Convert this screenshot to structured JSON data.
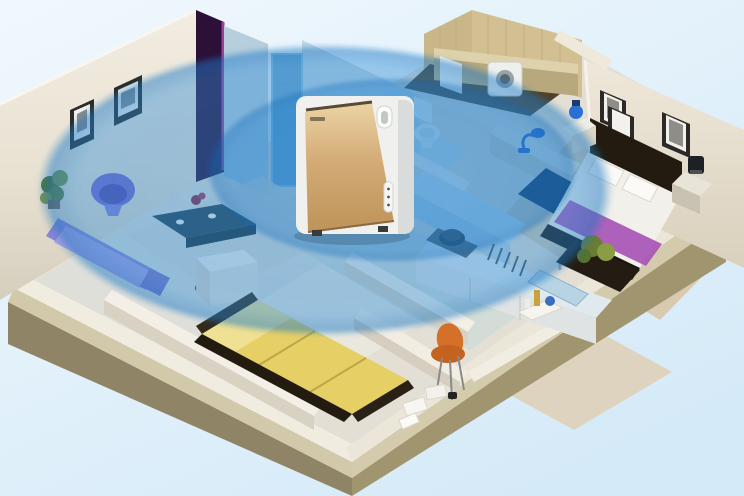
{
  "illustration": {
    "kind": "isometric-apartment-cutaway",
    "subject": "air purifier whole-home coverage",
    "device": {
      "name": "air-purifier",
      "finish": "champagne-gold",
      "parts": [
        "gold front panel",
        "white side body",
        "carry handle slot",
        "top air outlet slot",
        "side control strip",
        "feet"
      ]
    },
    "rooms": [
      {
        "name": "living-room",
        "items": [
          "wall frame",
          "wall frame",
          "potted plant",
          "purple tub chair",
          "purple sofa",
          "teal coffee table",
          "flower vase",
          "white sideboard",
          "area rug"
        ]
      },
      {
        "name": "hallway",
        "items": [
          "door",
          "purple accent panel"
        ]
      },
      {
        "name": "bathroom",
        "items": [
          "toilet",
          "blue vanity"
        ]
      },
      {
        "name": "laundry-bath",
        "items": [
          "tan tiled walls",
          "counter shelf",
          "washing machine",
          "white heater box"
        ]
      },
      {
        "name": "master-bedroom",
        "items": [
          "wall frame",
          "wall frame",
          "wall frame",
          "dark bed frame",
          "white bedding",
          "pillow",
          "pillow",
          "purple bed runner",
          "nightstand",
          "blue lamp",
          "nightstand",
          "dark lamp",
          "potted plant"
        ]
      },
      {
        "name": "kitchen",
        "items": [
          "back cabinets",
          "island counter",
          "sink",
          "faucet",
          "dish rack",
          "pot on stove",
          "navy bar counter",
          "blue desk lamp"
        ]
      },
      {
        "name": "second-bedroom",
        "items": [
          "yellow bed",
          "dark bed frame"
        ]
      },
      {
        "name": "study",
        "items": [
          "orange chair",
          "papers",
          "notebook",
          "camera"
        ]
      },
      {
        "name": "entry",
        "items": [
          "tray",
          "amber bottle",
          "blue sphere"
        ]
      }
    ]
  },
  "coverage": {
    "outer": {
      "cx": 325,
      "cy": 190,
      "rx": 288,
      "ry": 146
    },
    "inner": {
      "cx": 392,
      "cy": 170,
      "rx": 185,
      "ry": 92
    }
  },
  "palette": {
    "background_top": "#eff7fd",
    "background_bottom": "#d6eaf8",
    "coverage_blue": "#2c8cd7",
    "coverage_blue_inner": "#1473c6",
    "khaki_face_left": "#8f8466",
    "khaki_face_right": "#a1956f",
    "khaki_top": "#d4cbac",
    "wall_cream": "#efe9dd",
    "accent_purple": "#2c1038",
    "magenta_edge": "#a23d97",
    "tan_tile_a": "#c9b78a",
    "tan_tile_b": "#d2c093",
    "laundry_floor": "#50412a",
    "hall_wall": "#b7cedd",
    "hall_door": "#6fa6cc",
    "living_floor": "#dfdfda",
    "bedroom2_floor": "#e9e7de",
    "wood_floor": "#d8cab1",
    "kitchen_floor": "#d3dcd6",
    "sofa_purple": "#8d85d4",
    "sofa_cushion": "#a79fe0",
    "chair_purple": "#7a68cc",
    "chair_purple_seat": "#5648aa",
    "table_teal": "#2a4351",
    "flower_red": "#8d2746",
    "plant_green_dark": "#55722f",
    "plant_green_light": "#7c9440",
    "bed_yellow": "#e6d066",
    "bed_yellow_pillow": "#efe093",
    "bed_dark_frame": "#231b10",
    "mattress_white": "#f2f0ea",
    "runner_purple": "#a855b5",
    "navy_counter": "#16294a",
    "lamp_blue": "#2f62c4",
    "chair_orange": "#c4631f",
    "purifier_white": "#f0f1ef",
    "purifier_shade": "#d9dcda",
    "purifier_gold_top": "#ecd3a4",
    "purifier_gold_mid": "#d3ab76",
    "purifier_gold_bottom": "#bd9359"
  }
}
